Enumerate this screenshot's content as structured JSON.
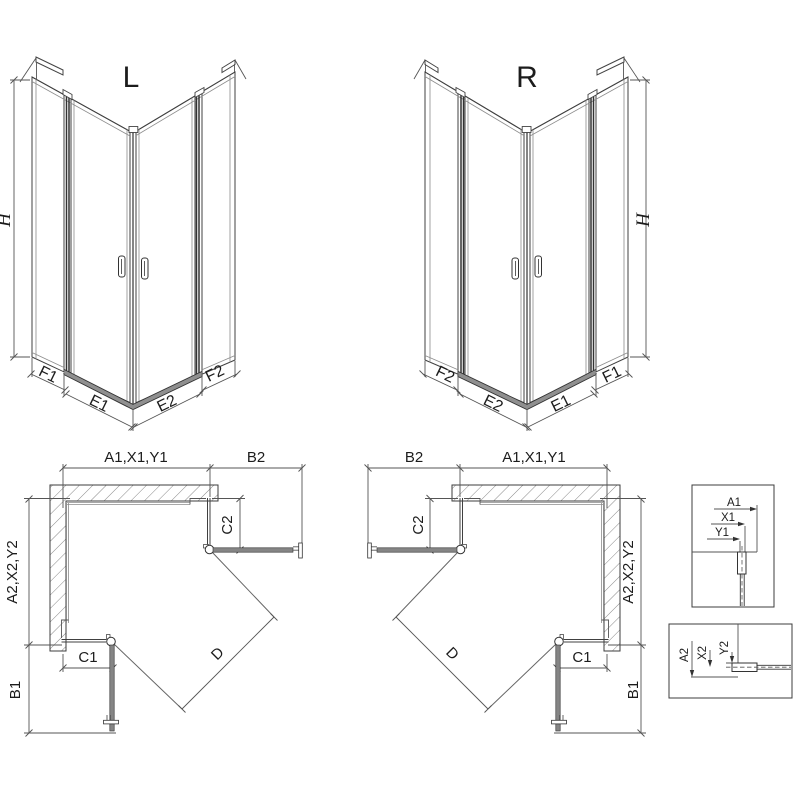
{
  "drawing": {
    "iso_left": {
      "title": "L",
      "height_label": "H",
      "widths": {
        "f1": "F1",
        "e1": "E1",
        "e2": "E2",
        "f2": "F2"
      }
    },
    "iso_right": {
      "title": "R",
      "height_label": "H",
      "widths": {
        "f1": "F1",
        "e1": "E1",
        "e2": "E2",
        "f2": "F2"
      }
    },
    "plan_left": {
      "top_width": "A1,X1,Y1",
      "return_top": "B2",
      "side_width": "A2,X2,Y2",
      "fixed_top": "C2",
      "fixed_bottom": "C1",
      "return_bottom": "B1",
      "entry_diagonal": "D"
    },
    "plan_right": {
      "top_width": "A1,X1,Y1",
      "return_top": "B2",
      "side_width": "A2,X2,Y2",
      "fixed_top": "C2",
      "fixed_bottom": "C1",
      "return_bottom": "B1",
      "entry_diagonal": "D"
    },
    "detail_top": {
      "dims": [
        "A1",
        "X1",
        "Y1"
      ]
    },
    "detail_bottom": {
      "dims": [
        "A2",
        "X2",
        "Y2"
      ]
    }
  },
  "colors": {
    "line": "#404040",
    "dim": "#555555",
    "panel_gray": "#858585",
    "hatch": "#7a7a7a"
  }
}
